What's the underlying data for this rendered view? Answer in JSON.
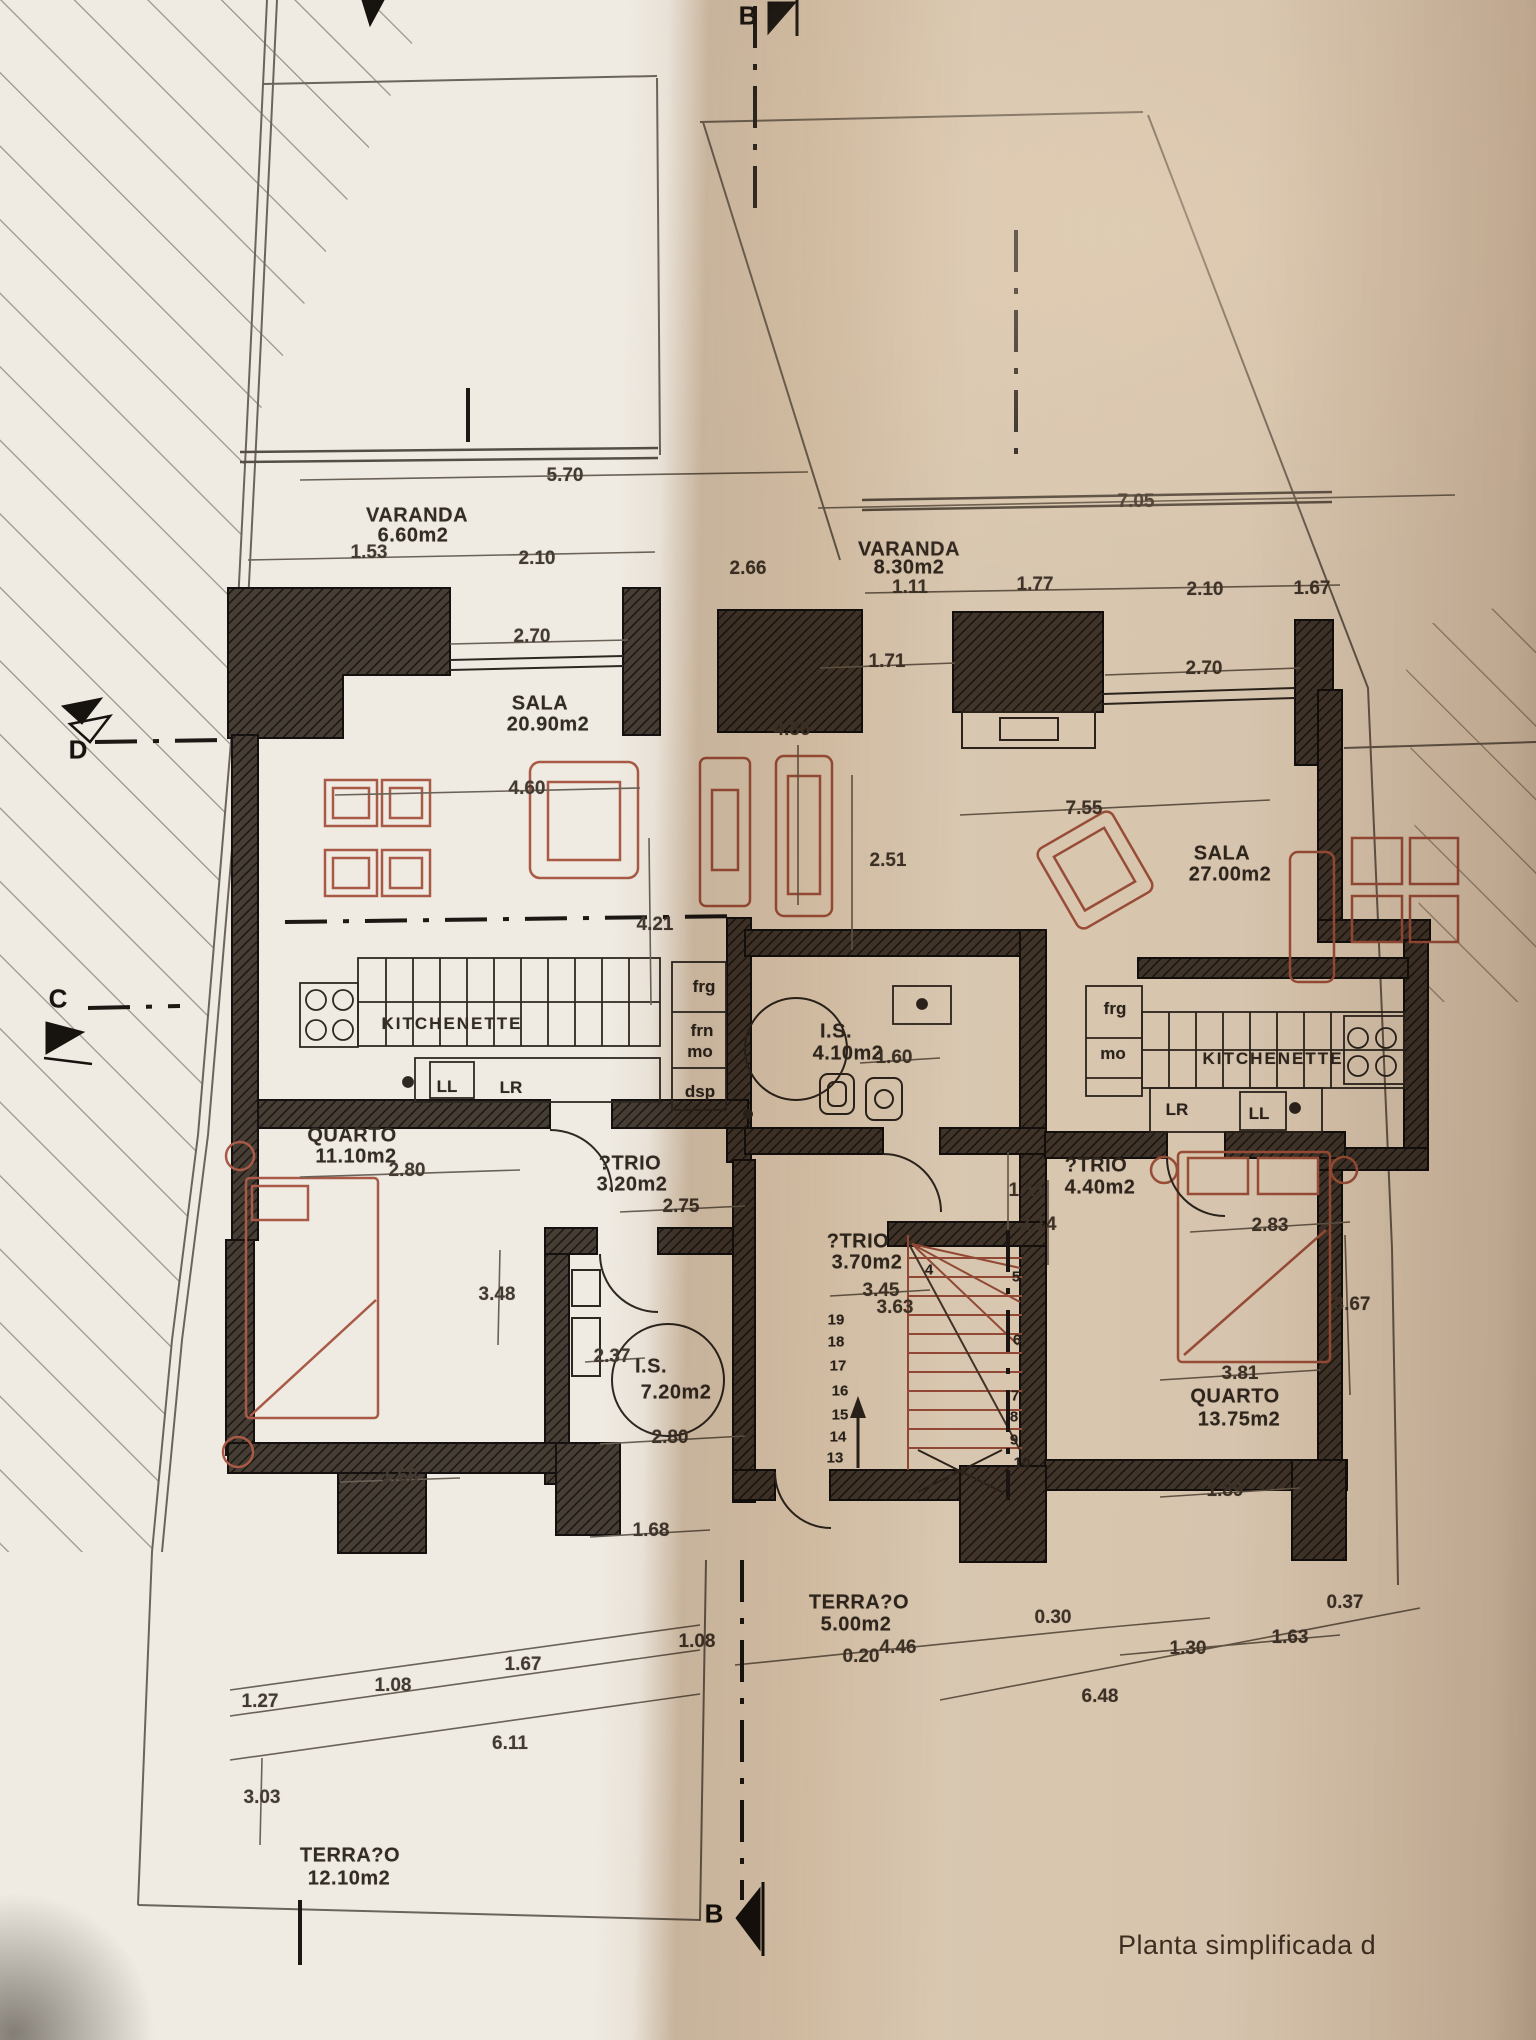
{
  "caption": "Planta simplificada d",
  "colors": {
    "paper": "#efeae2",
    "wall": "#3c352f",
    "furniture_red": "#a85a46",
    "line": "#2e2822"
  },
  "texts": {
    "rooms": [
      {
        "n": "room-varanda-left",
        "t": "VARANDA",
        "x": 417,
        "y": 516
      },
      {
        "n": "area-varanda-left",
        "t": "6.60m2",
        "x": 413,
        "y": 536
      },
      {
        "n": "room-sala-left",
        "t": "SALA",
        "x": 540,
        "y": 704
      },
      {
        "n": "area-sala-left",
        "t": "20.90m2",
        "x": 548,
        "y": 725
      },
      {
        "n": "room-kitchenette-left",
        "t": "KITCHENETTE",
        "x": 452,
        "y": 1024,
        "cls": "kitch"
      },
      {
        "n": "room-quarto-left",
        "t": "QUARTO",
        "x": 352,
        "y": 1136
      },
      {
        "n": "area-quarto-left",
        "t": "11.10m2",
        "x": 356,
        "y": 1157
      },
      {
        "n": "room-atrio-left",
        "t": "?TRIO",
        "x": 630,
        "y": 1164
      },
      {
        "n": "area-atrio-left",
        "t": "3.20m2",
        "x": 632,
        "y": 1185
      },
      {
        "n": "room-is-left",
        "t": "I.S.",
        "x": 651,
        "y": 1367
      },
      {
        "n": "area-is-left",
        "t": "7.20m2",
        "x": 676,
        "y": 1393
      },
      {
        "n": "room-terraco-left",
        "t": "TERRA?O",
        "x": 350,
        "y": 1856
      },
      {
        "n": "area-terraco-left",
        "t": "12.10m2",
        "x": 349,
        "y": 1879
      },
      {
        "n": "room-varanda-right",
        "t": "VARANDA",
        "x": 909,
        "y": 550
      },
      {
        "n": "area-varanda-right",
        "t": "8.30m2",
        "x": 909,
        "y": 568
      },
      {
        "n": "room-sala-right",
        "t": "SALA",
        "x": 1222,
        "y": 854
      },
      {
        "n": "area-sala-right",
        "t": "27.00m2",
        "x": 1230,
        "y": 875
      },
      {
        "n": "room-kitchenette-right",
        "t": "KITCHENETTE",
        "x": 1273,
        "y": 1059,
        "cls": "kitch"
      },
      {
        "n": "room-atrio-center",
        "t": "?TRIO",
        "x": 858,
        "y": 1242
      },
      {
        "n": "area-atrio-center",
        "t": "3.70m2",
        "x": 867,
        "y": 1263
      },
      {
        "n": "room-atrio-right",
        "t": "?TRIO",
        "x": 1096,
        "y": 1166
      },
      {
        "n": "area-atrio-right",
        "t": "4.40m2",
        "x": 1100,
        "y": 1188
      },
      {
        "n": "room-is-center",
        "t": "I.S.",
        "x": 836,
        "y": 1032
      },
      {
        "n": "area-is-center",
        "t": "4.10m2",
        "x": 848,
        "y": 1054
      },
      {
        "n": "room-quarto-right",
        "t": "QUARTO",
        "x": 1235,
        "y": 1397
      },
      {
        "n": "area-quarto-right",
        "t": "13.75m2",
        "x": 1239,
        "y": 1420
      },
      {
        "n": "room-terraco-center",
        "t": "TERRA?O",
        "x": 859,
        "y": 1603
      },
      {
        "n": "area-terraco-center",
        "t": "5.00m2",
        "x": 856,
        "y": 1625
      }
    ],
    "dimensions": [
      {
        "t": "5.70",
        "x": 565,
        "y": 476
      },
      {
        "t": "1.53",
        "x": 369,
        "y": 553
      },
      {
        "t": "2.10",
        "x": 537,
        "y": 559
      },
      {
        "t": "2.66",
        "x": 748,
        "y": 569
      },
      {
        "t": "2.70",
        "x": 532,
        "y": 637
      },
      {
        "t": "4.60",
        "x": 527,
        "y": 789
      },
      {
        "t": "4.21",
        "x": 655,
        "y": 925
      },
      {
        "t": "7.05",
        "x": 1136,
        "y": 502
      },
      {
        "t": "1.11",
        "x": 910,
        "y": 588
      },
      {
        "t": "1.77",
        "x": 1035,
        "y": 585
      },
      {
        "t": "2.10",
        "x": 1205,
        "y": 590
      },
      {
        "t": "1.67",
        "x": 1312,
        "y": 589
      },
      {
        "t": "1.71",
        "x": 887,
        "y": 662
      },
      {
        "t": "2.70",
        "x": 1204,
        "y": 669
      },
      {
        "t": "2.51",
        "x": 888,
        "y": 861
      },
      {
        "t": "7.55",
        "x": 1084,
        "y": 809
      },
      {
        "t": "4.36",
        "x": 792,
        "y": 730
      },
      {
        "t": "1.60",
        "x": 894,
        "y": 1058
      },
      {
        "t": "2.80",
        "x": 407,
        "y": 1171
      },
      {
        "t": "2.75",
        "x": 681,
        "y": 1207
      },
      {
        "t": "3.48",
        "x": 497,
        "y": 1295
      },
      {
        "t": "3.45",
        "x": 881,
        "y": 1291
      },
      {
        "t": "3.63",
        "x": 895,
        "y": 1308
      },
      {
        "t": "1.15",
        "x": 1027,
        "y": 1191
      },
      {
        "t": "2.14",
        "x": 1038,
        "y": 1225
      },
      {
        "t": "2.37",
        "x": 612,
        "y": 1357
      },
      {
        "t": "2.80",
        "x": 670,
        "y": 1438
      },
      {
        "t": "2.83",
        "x": 1270,
        "y": 1226
      },
      {
        "t": "3.67",
        "x": 1352,
        "y": 1305
      },
      {
        "t": "3.81",
        "x": 1240,
        "y": 1374
      },
      {
        "t": "1.89",
        "x": 1225,
        "y": 1491
      },
      {
        "t": "1.68",
        "x": 400,
        "y": 1477
      },
      {
        "t": "1.68",
        "x": 651,
        "y": 1531
      },
      {
        "t": "1.27",
        "x": 260,
        "y": 1702
      },
      {
        "t": "1.08",
        "x": 393,
        "y": 1686
      },
      {
        "t": "1.67",
        "x": 523,
        "y": 1665
      },
      {
        "t": "1.08",
        "x": 697,
        "y": 1642
      },
      {
        "t": "6.11",
        "x": 510,
        "y": 1744
      },
      {
        "t": "3.03",
        "x": 262,
        "y": 1798
      },
      {
        "t": "0.20",
        "x": 861,
        "y": 1657
      },
      {
        "t": "4.46",
        "x": 898,
        "y": 1648
      },
      {
        "t": "0.30",
        "x": 1053,
        "y": 1618
      },
      {
        "t": "0.37",
        "x": 1345,
        "y": 1603
      },
      {
        "t": "1.30",
        "x": 1188,
        "y": 1649
      },
      {
        "t": "1.63",
        "x": 1290,
        "y": 1638
      },
      {
        "t": "6.48",
        "x": 1100,
        "y": 1697
      }
    ],
    "appliances": [
      {
        "t": "frg",
        "x": 704,
        "y": 987
      },
      {
        "t": "frn",
        "x": 702,
        "y": 1031
      },
      {
        "t": "mo",
        "x": 700,
        "y": 1052
      },
      {
        "t": "dsp",
        "x": 700,
        "y": 1092
      },
      {
        "t": "LL",
        "x": 447,
        "y": 1087
      },
      {
        "t": "LR",
        "x": 511,
        "y": 1088
      },
      {
        "t": "frg",
        "x": 1115,
        "y": 1009
      },
      {
        "t": "mo",
        "x": 1113,
        "y": 1054
      },
      {
        "t": "LR",
        "x": 1177,
        "y": 1110
      },
      {
        "t": "LL",
        "x": 1259,
        "y": 1114
      }
    ],
    "stair_numbers": [
      {
        "t": "19",
        "x": 836,
        "y": 1320
      },
      {
        "t": "18",
        "x": 836,
        "y": 1342
      },
      {
        "t": "17",
        "x": 838,
        "y": 1366
      },
      {
        "t": "16",
        "x": 840,
        "y": 1391
      },
      {
        "t": "15",
        "x": 840,
        "y": 1415
      },
      {
        "t": "14",
        "x": 838,
        "y": 1437
      },
      {
        "t": "13",
        "x": 835,
        "y": 1458
      },
      {
        "t": "4",
        "x": 929,
        "y": 1270
      },
      {
        "t": "5",
        "x": 1016,
        "y": 1277
      },
      {
        "t": "6",
        "x": 1017,
        "y": 1340
      },
      {
        "t": "7",
        "x": 1015,
        "y": 1396
      },
      {
        "t": "8",
        "x": 1014,
        "y": 1417
      },
      {
        "t": "9",
        "x": 1014,
        "y": 1440
      },
      {
        "t": "10",
        "x": 1022,
        "y": 1463
      }
    ],
    "markers": [
      {
        "t": "B",
        "x": 748,
        "y": 16,
        "n": "section-marker-b-top"
      },
      {
        "t": "B",
        "x": 714,
        "y": 1914,
        "n": "section-marker-b-bottom"
      },
      {
        "t": "D",
        "x": 78,
        "y": 750,
        "n": "section-marker-d"
      },
      {
        "t": "C",
        "x": 58,
        "y": 999,
        "n": "section-marker-c"
      }
    ]
  }
}
